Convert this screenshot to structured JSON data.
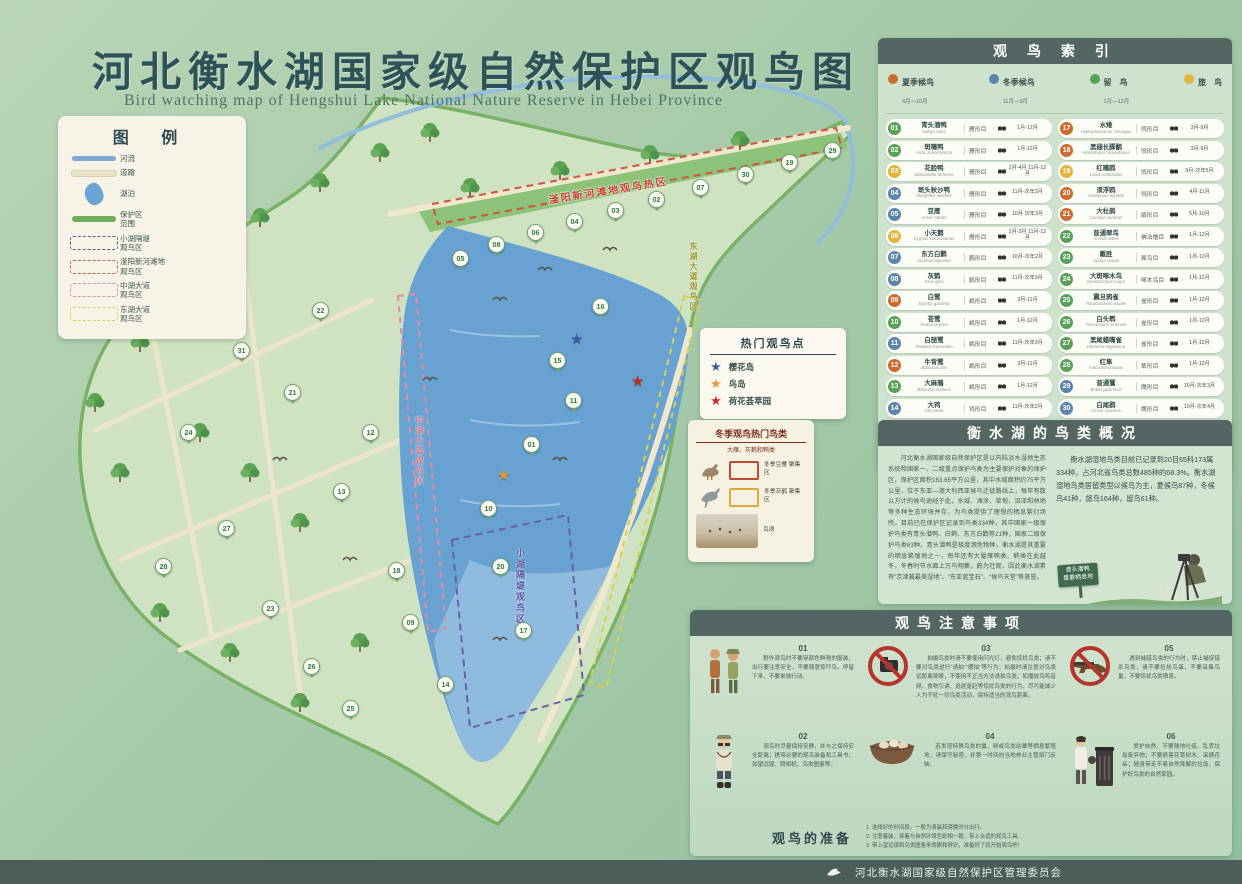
{
  "title": {
    "zh": "河北衡水湖国家级自然保护区观鸟图",
    "en": "Bird watching map of Hengshui Lake National Nature Reserve in Hebei Province"
  },
  "legend": {
    "title": "图 例",
    "items": [
      {
        "type": "river",
        "label": "河流"
      },
      {
        "type": "road",
        "label": "道路"
      },
      {
        "type": "lake",
        "label": "湖泊"
      },
      {
        "type": "boundary",
        "label": "保护区\n范围"
      },
      {
        "type": "d-purple",
        "label": "小湖隔堤\n观鸟区"
      },
      {
        "type": "d-red",
        "label": "滏阳新河滩地\n观鸟区"
      },
      {
        "type": "d-pink",
        "label": "中湖大道\n观鸟区"
      },
      {
        "type": "d-yellow",
        "label": "东湖大道\n观鸟区"
      }
    ]
  },
  "index": {
    "title": "观 鸟 索 引",
    "seasons": [
      {
        "key": "summer",
        "label": "夏季候鸟",
        "months": "4月—10月"
      },
      {
        "key": "winter",
        "label": "冬季候鸟",
        "months": "11月—3月"
      },
      {
        "key": "resident",
        "label": "留　鸟",
        "months": "1月—12月"
      },
      {
        "key": "passage",
        "label": "旅　鸟",
        "months": ""
      }
    ],
    "birds_left": [
      {
        "no": "01",
        "name": "青头潜鸭",
        "latin": "Aythya baeri",
        "order": "雁形目",
        "months": "1月-12月",
        "season": "resident"
      },
      {
        "no": "02",
        "name": "斑嘴鸭",
        "latin": "Anas zonorhyncha",
        "order": "雁形目",
        "months": "1月-12月",
        "season": "resident"
      },
      {
        "no": "03",
        "name": "花脸鸭",
        "latin": "Sibirionetta formosa",
        "order": "雁形目",
        "months": "2月-4月 11月-12月",
        "season": "passage"
      },
      {
        "no": "04",
        "name": "斑头秋沙鸭",
        "latin": "Mergellus albellus",
        "order": "雁形目",
        "months": "11月-次年3月",
        "season": "winter"
      },
      {
        "no": "05",
        "name": "豆雁",
        "latin": "Anser fabalis",
        "order": "雁形目",
        "months": "10月-次年3月",
        "season": "winter"
      },
      {
        "no": "06",
        "name": "小天鹅",
        "latin": "Cygnus columbianus",
        "order": "雁形目",
        "months": "2月-3月 11月-12月",
        "season": "passage"
      },
      {
        "no": "07",
        "name": "东方白鹳",
        "latin": "Ciconia boyciana",
        "order": "鹳形目",
        "months": "10月-次年2月",
        "season": "winter"
      },
      {
        "no": "08",
        "name": "灰鹤",
        "latin": "Grus grus",
        "order": "鹤形目",
        "months": "11月-次年3月",
        "season": "winter"
      },
      {
        "no": "09",
        "name": "白鹭",
        "latin": "Egretta garzetta",
        "order": "鹈形目",
        "months": "3月-11月",
        "season": "summer"
      },
      {
        "no": "10",
        "name": "苍鹭",
        "latin": "Ardea cinerea",
        "order": "鹈形目",
        "months": "1月-12月",
        "season": "resident"
      },
      {
        "no": "11",
        "name": "白琵鹭",
        "latin": "Platalea leucorodia",
        "order": "鹈形目",
        "months": "11月-次年3月",
        "season": "winter"
      },
      {
        "no": "12",
        "name": "牛背鹭",
        "latin": "Bubulcus ibis",
        "order": "鹈形目",
        "months": "3月-11月",
        "season": "summer"
      },
      {
        "no": "13",
        "name": "大麻鳽",
        "latin": "Botaurus stellaris",
        "order": "鹈形目",
        "months": "1月-12月",
        "season": "resident"
      },
      {
        "no": "14",
        "name": "大鸨",
        "latin": "Otis tarda",
        "order": "鸨形目",
        "months": "11月-次年2月",
        "season": "winter"
      },
      {
        "no": "15",
        "name": "凤头䴙䴘",
        "latin": "Podiceps cristatus",
        "order": "䴙䴘目",
        "months": "1月-12月",
        "season": "resident"
      },
      {
        "no": "16",
        "name": "普通鸬鹚",
        "latin": "Phalacrocorax carbo",
        "order": "鲣鸟目",
        "months": "1月-12月",
        "season": "resident"
      }
    ],
    "birds_right": [
      {
        "no": "17",
        "name": "水雉",
        "latin": "Hydrophasianus chirurgus",
        "order": "鸻形目",
        "months": "3月-9月",
        "season": "summer"
      },
      {
        "no": "18",
        "name": "黑翅长脚鹬",
        "latin": "Himantopus himantopus",
        "order": "鸻形目",
        "months": "3月-9月",
        "season": "summer"
      },
      {
        "no": "19",
        "name": "红嘴鸥",
        "latin": "Larus ridibundus",
        "order": "鸻形目",
        "months": "9月-次年5月",
        "season": "passage"
      },
      {
        "no": "20",
        "name": "须浮鸥",
        "latin": "Chlidonias hybrida",
        "order": "鸻形目",
        "months": "4月-11月",
        "season": "summer"
      },
      {
        "no": "21",
        "name": "大杜鹃",
        "latin": "Cuculus canorus",
        "order": "鹃形目",
        "months": "5月-10月",
        "season": "summer"
      },
      {
        "no": "22",
        "name": "普通翠鸟",
        "latin": "Alcedo atthis",
        "order": "佛法僧目",
        "months": "1月-12月",
        "season": "resident"
      },
      {
        "no": "23",
        "name": "戴胜",
        "latin": "Upupa epops",
        "order": "犀鸟目",
        "months": "1月-12月",
        "season": "resident"
      },
      {
        "no": "24",
        "name": "大斑啄木鸟",
        "latin": "Dendrocopos major",
        "order": "啄木鸟目",
        "months": "1月-12月",
        "season": "resident"
      },
      {
        "no": "25",
        "name": "震旦鸦雀",
        "latin": "Paradoxornis heudei",
        "order": "雀形目",
        "months": "1月-12月",
        "season": "resident"
      },
      {
        "no": "26",
        "name": "白头鹎",
        "latin": "Pycnonotus sinensis",
        "order": "雀形目",
        "months": "1月-12月",
        "season": "resident"
      },
      {
        "no": "27",
        "name": "黑尾蜡嘴雀",
        "latin": "Eophona migratoria",
        "order": "雀形目",
        "months": "1月-12月",
        "season": "resident"
      },
      {
        "no": "28",
        "name": "红隼",
        "latin": "Falco tinnunculus",
        "order": "隼形目",
        "months": "1月-12月",
        "season": "resident"
      },
      {
        "no": "29",
        "name": "普通鵟",
        "latin": "Buteo japonicus",
        "order": "鹰形目",
        "months": "10月-次年3月",
        "season": "winter"
      },
      {
        "no": "30",
        "name": "白尾鹞",
        "latin": "Circus cyaneus",
        "order": "鹰形目",
        "months": "10月-次年4月",
        "season": "winter"
      },
      {
        "no": "31",
        "name": "短耳鸮",
        "latin": "Asio flammeus",
        "order": "鸮形目",
        "months": "1月-12月",
        "season": "resident"
      }
    ]
  },
  "hotspots": {
    "title": "热门观鸟点",
    "items": [
      {
        "color": "#3d5ba9",
        "star": "★",
        "label": "樱花岛"
      },
      {
        "color": "#e8992e",
        "star": "★",
        "label": "鸟岛"
      },
      {
        "color": "#c62a28",
        "star": "★",
        "label": "荷花荟萃园"
      }
    ]
  },
  "winter": {
    "title": "冬季观鸟热门鸟类",
    "subtitle": "大雁、灰鹤和鸭类",
    "items": [
      {
        "label": "冬季豆雁\n聚集区"
      },
      {
        "label": "冬季灰鹤\n聚集区"
      },
      {
        "label": "鸟浪"
      }
    ]
  },
  "overview": {
    "title": "衡水湖的鸟类概况",
    "left_text": "河北衡水湖国家级自然保护区是以内陆淡水湿地生态系统和国家一、二级重点保护鸟类为主要保护对象的保护区，保护区面积163.65平方公里，其中水域面积约75平方公里，位于东亚—澳大利西亚候鸟迁徙路线上，每年有数以万计的候鸟途经于此，水域、滩涂、草甸、沼泽和林地等多种生态环境并存，为鸟类提供了理想的栖息繁衍场所。目前已在保护区记录到鸟类334种，其中国家一级保护鸟类有青头潜鸭、白鹤、东方白鹳等21种，国家二级保护鸟类63种。青头潜鸭是极度濒危物种，衡水湖是其重要的栖息繁殖地之一，每年还有大量雁鸭类、鹤类在此越冬，冬春时节水面上万鸟翔集，蔚为壮观，因此衡水湖素有“京津冀最美湿地”、“东亚蓝宝石”、“候鸟天堂”等美誉。",
    "stats_text": "衡水湖湿地鸟类目前已记录到20目65科173属334种，占河北省鸟类总数485种的68.3%。衡水湖湿地鸟类居留类型以候鸟为主，夏候鸟87种，冬候鸟41种，旅鸟164种，留鸟61种。",
    "sign_line1": "青头潜鸭",
    "sign_line2": "重要栖息地"
  },
  "notes": {
    "title": "观鸟注意事项",
    "items": [
      {
        "no": "01",
        "text": "野外观鸟时不要穿颜色鲜艳的服装，出行要注意安全，不要随意惊吓鸟，停留下来，不要单独行动。"
      },
      {
        "no": "02",
        "text": "观鸟时尽量保持安静，并与之保持安全距离；携带必要的观鸟装备和工具书，如望远镜、照相机、鸟类图鉴等。"
      },
      {
        "no": "03",
        "text": "拍摄鸟类时请不要使用闪光灯，避免惊扰鸟类；请不要对鸟类进行“诱拍”“摆拍”等行为；拍摄时请注意对鸟类远距离观察，不使用不正当方法诱拍鸟类，如播放鸟鸣音频、食物引诱、追逐驱赶等惊扰鸟类的行为，尽可能减少人为干扰一切鸟类活动，保持适当的观鸟距离。"
      },
      {
        "no": "04",
        "text": "若发现特殊鸟类的巢、卵或鸟类幼雏等栖息繁殖地，请保守秘密，并第一时间向当地林业主管部门反映。"
      },
      {
        "no": "05",
        "text": "遇到捕猎鸟类的行为时，禁止捕捉猎杀鸟类，请不要捡拾鸟蛋，不要采集鸟巢，不要惊扰鸟类栖息。"
      },
      {
        "no": "06",
        "text": "爱护自然，不要随地吐痰、乱丢垃圾废弃物；不要损害花草树木、采摘花朵；随身带走不易自然降解的垃圾，保护好鸟类的自然家园。"
      }
    ],
    "prep": {
      "title": "观鸟的准备",
      "lines": [
        "1. 选择好的时间段，一般为清晨和傍晚时分出行。",
        "2. 注意着装，穿着与自然环境色彩相一致，带上合适的观鸟工具。",
        "3. 带上望远镜和鸟类图鉴来观察和辨识，准备好了就开始观鸟吧！"
      ]
    }
  },
  "map": {
    "labels": {
      "hot_area": "滏阳新河滩地观鸟热区",
      "xiaohu": "小湖隔堤观鸟区",
      "zhonghu": "中湖大道观鸟区",
      "donghu": "东湖大道观鸟区"
    },
    "stars": [
      {
        "color": "#3d5ba9",
        "x": 570,
        "y": 332
      },
      {
        "color": "#e8992e",
        "x": 497,
        "y": 468
      },
      {
        "color": "#c62a28",
        "x": 631,
        "y": 374
      }
    ],
    "markers": [
      {
        "n": "05",
        "x": 452,
        "y": 250
      },
      {
        "n": "08",
        "x": 488,
        "y": 236
      },
      {
        "n": "06",
        "x": 527,
        "y": 224
      },
      {
        "n": "04",
        "x": 566,
        "y": 213
      },
      {
        "n": "03",
        "x": 607,
        "y": 202
      },
      {
        "n": "02",
        "x": 648,
        "y": 191
      },
      {
        "n": "07",
        "x": 692,
        "y": 179
      },
      {
        "n": "30",
        "x": 737,
        "y": 166
      },
      {
        "n": "19",
        "x": 781,
        "y": 154
      },
      {
        "n": "29",
        "x": 824,
        "y": 142
      },
      {
        "n": "16",
        "x": 592,
        "y": 298
      },
      {
        "n": "15",
        "x": 549,
        "y": 352
      },
      {
        "n": "11",
        "x": 565,
        "y": 392
      },
      {
        "n": "01",
        "x": 523,
        "y": 436
      },
      {
        "n": "10",
        "x": 480,
        "y": 500
      },
      {
        "n": "20",
        "x": 492,
        "y": 558
      },
      {
        "n": "17",
        "x": 515,
        "y": 622
      },
      {
        "n": "14",
        "x": 437,
        "y": 676
      },
      {
        "n": "18",
        "x": 388,
        "y": 562
      },
      {
        "n": "09",
        "x": 402,
        "y": 614
      },
      {
        "n": "12",
        "x": 362,
        "y": 424
      },
      {
        "n": "13",
        "x": 333,
        "y": 483
      },
      {
        "n": "21",
        "x": 284,
        "y": 384
      },
      {
        "n": "22",
        "x": 312,
        "y": 302
      },
      {
        "n": "31",
        "x": 233,
        "y": 342
      },
      {
        "n": "24",
        "x": 180,
        "y": 424
      },
      {
        "n": "27",
        "x": 218,
        "y": 520
      },
      {
        "n": "28",
        "x": 155,
        "y": 558
      },
      {
        "n": "23",
        "x": 262,
        "y": 600
      },
      {
        "n": "26",
        "x": 303,
        "y": 658
      },
      {
        "n": "25",
        "x": 342,
        "y": 700
      }
    ]
  },
  "footer": {
    "org": "河北衡水湖国家级自然保护区管理委员会"
  }
}
